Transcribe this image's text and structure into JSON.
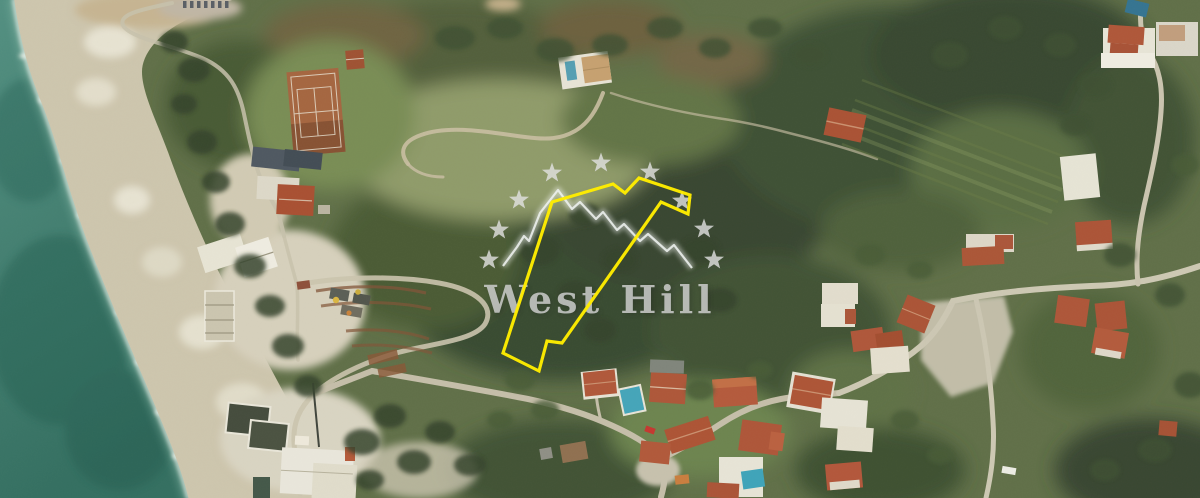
{
  "map": {
    "type": "aerial-photo",
    "sea_color_top": "#4d8c7d",
    "sea_color_bottom": "#2d6a5b",
    "shore_color": "#ccc4ab",
    "field_color": "#8c9865",
    "forest_color": "#33432a",
    "road_color": "#c3bca6",
    "roof_color": "#ad5133",
    "tennis_court_color": "#a2613a"
  },
  "parcel": {
    "outline_color": "#ffec00",
    "points": "552,202 613,184 625,193 639,178 690,195 688,214 661,202 562,343 547,341 539,371 503,353"
  },
  "watermark": {
    "brand_text": "West Hill",
    "text_color": "#d6d6d6",
    "star_color": "#e2e2e2",
    "stars_count": 9,
    "star_positions": [
      [
        489,
        260
      ],
      [
        499,
        230
      ],
      [
        519,
        200
      ],
      [
        552,
        173
      ],
      [
        601,
        163
      ],
      [
        650,
        172
      ],
      [
        682,
        201
      ],
      [
        704,
        229
      ],
      [
        714,
        260
      ]
    ],
    "ridge_color": "#eef1ef",
    "ridge_points": "503,266 517,247 524,236 529,241 540,213 558,190 572,209 580,202 596,219 603,212 617,230 624,224 640,241 648,234 667,251 674,245 692,268"
  }
}
